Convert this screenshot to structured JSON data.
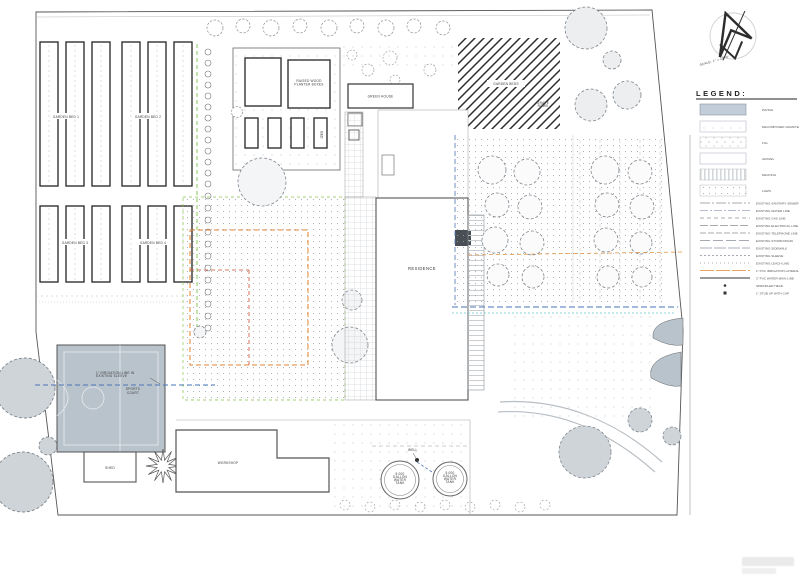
{
  "plan": {
    "labels": {
      "garden_bed_1": "GARDEN BED 1",
      "garden_bed_2": "GARDEN BED 2",
      "garden_bed_3": "GARDEN BED 3",
      "garden_bed_4": "GARDEN BED 4",
      "raised_planters": [
        "RAISED WOOD",
        "PLANTER BOXES"
      ],
      "planter_bed": "BED",
      "greenhouse": "GREEN HOUSE",
      "hatch_area": "GARDEN BEDS",
      "grape_rows": [
        "GRAPE",
        "ROWS"
      ],
      "residence": "RESIDENCE",
      "sports_court": [
        "SPORTS",
        "COURT"
      ],
      "shed": "SHED",
      "workshop": "WORKSHOP",
      "well": "WELL",
      "tank": [
        "5,000",
        "GALLON",
        "WATER",
        "TANK"
      ],
      "irrigation_note": [
        "1\" IRRIGATION LINE IN",
        "EXISTING SLEEVE"
      ]
    },
    "north": {
      "scale_note": "SCALE: 1\" = 20'-0\""
    }
  },
  "legend": {
    "title": "LEGEND:",
    "areas": [
      "PAVING",
      "DECOMPOSED GRANITE",
      "FILL",
      "GRAVEL",
      "DECKING",
      "LAWN"
    ],
    "lines": [
      "EXISTING SANITARY SEWER",
      "EXISTING WATER LINE",
      "EXISTING GAS LINE",
      "EXISTING ELECTRICAL LINE",
      "EXISTING TELEPHONE LINE",
      "EXISTING STORM DRAIN",
      "EXISTING SIDEWALK",
      "EXISTING SLEEVE",
      "EXISTING LEACH LINE",
      "1\" PVC IRRIGATION LATERAL",
      "2\" PVC WATER MAIN LINE",
      "SPRINKLER HEAD",
      "1\" STUB UP WITH CAP"
    ]
  },
  "colors": {
    "paving": "#c3cdd9",
    "water_line": "#4a74b8",
    "irrigation_line": "#e2862f",
    "landscape_line": "#7dc24b",
    "lawn_line": "#6cc4d6"
  }
}
